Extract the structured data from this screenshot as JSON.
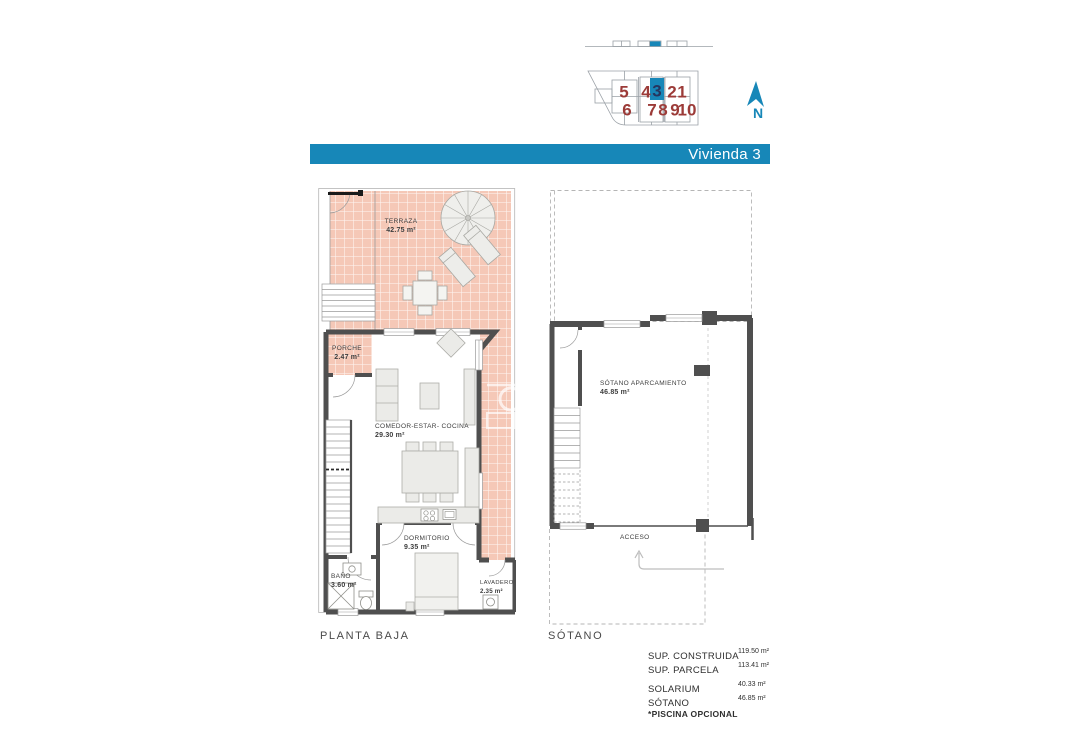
{
  "colors": {
    "accent": "#1787b8",
    "unit_number": "#9c3b38",
    "highlighted_unit_number": "#26355e",
    "terrace_tile": "#f5c8b7",
    "wall": "#4f4f4f"
  },
  "site_plan": {
    "north_label": "N",
    "units": [
      {
        "label": "5",
        "highlighted": false
      },
      {
        "label": "6",
        "highlighted": false
      },
      {
        "label": "4",
        "highlighted": false
      },
      {
        "label": "3",
        "highlighted": true
      },
      {
        "label": "2",
        "highlighted": false
      },
      {
        "label": "1",
        "highlighted": false
      },
      {
        "label": "7",
        "highlighted": false
      },
      {
        "label": "8",
        "highlighted": false
      },
      {
        "label": "9",
        "highlighted": false
      },
      {
        "label": "10",
        "highlighted": false
      }
    ]
  },
  "title_bar": {
    "label": "Vivienda 3"
  },
  "ground_floor": {
    "plan_label": "PLANTA BAJA",
    "rooms": {
      "terraza": {
        "name": "TERRAZA",
        "area": "42.75 m²"
      },
      "porche": {
        "name": "PORCHE",
        "area": "2.47 m²"
      },
      "salon": {
        "name": "COMEDOR-ESTAR- COCINA",
        "area": "29.30 m²"
      },
      "dormitorio": {
        "name": "DORMITORIO",
        "area": "9.35 m²"
      },
      "bano": {
        "name": "BAÑO",
        "area": "3.60 m²"
      },
      "lavadero": {
        "name": "LAVADERO",
        "area": "2.35 m²"
      }
    }
  },
  "basement": {
    "plan_label": "SÓTANO",
    "rooms": {
      "aparcamiento": {
        "name": "SÓTANO APARCAMIENTO",
        "area": "46.85 m²"
      }
    },
    "access_label": "ACCESO"
  },
  "summary": {
    "rows": [
      {
        "label": "SUP. CONSTRUIDA",
        "value": "119.50 m²"
      },
      {
        "label": "SUP. PARCELA",
        "value": "113.41 m²"
      },
      {
        "label": "SOLARIUM",
        "value": "40.33 m²"
      },
      {
        "label": "SÓTANO",
        "value": "46.85 m²"
      }
    ],
    "footnote": "*PISCINA OPCIONAL"
  }
}
